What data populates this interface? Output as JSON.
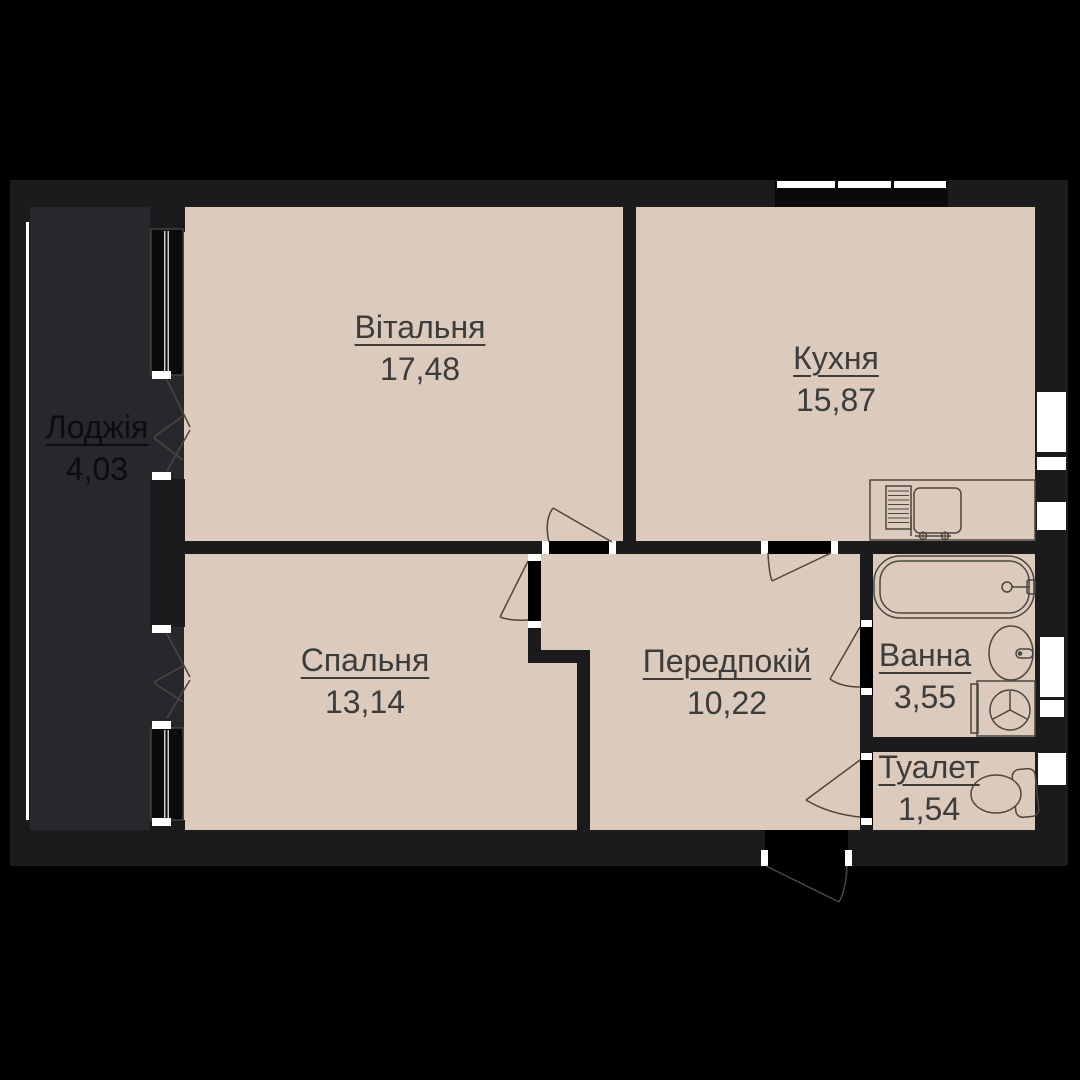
{
  "plan": {
    "title": "apartment-floor-plan",
    "colors": {
      "background": "#000000",
      "wall": "#1b1b1e",
      "window_block": "#0a0a0c",
      "floor": "#dccabc",
      "loggia_floor": "#28282c",
      "furniture_line": "#4d463f",
      "label_text": "#3c3c3c",
      "loggia_label_text": "#0d0d0f",
      "glazing_white": "#ffffff"
    },
    "rooms": [
      {
        "name": "Вітальня",
        "area": "17,48"
      },
      {
        "name": "Кухня",
        "area": "15,87"
      },
      {
        "name": "Лоджія",
        "area": "4,03"
      },
      {
        "name": "Спальня",
        "area": "13,14"
      },
      {
        "name": "Передпокій",
        "area": "10,22"
      },
      {
        "name": "Ванна",
        "area": "3,55"
      },
      {
        "name": "Туалет",
        "area": "1,54"
      }
    ],
    "icons": [
      "kitchen-sink-icon",
      "bathtub-icon",
      "washbasin-icon",
      "washing-machine-icon",
      "toilet-icon",
      "window-icon",
      "door-swing-icon"
    ]
  }
}
